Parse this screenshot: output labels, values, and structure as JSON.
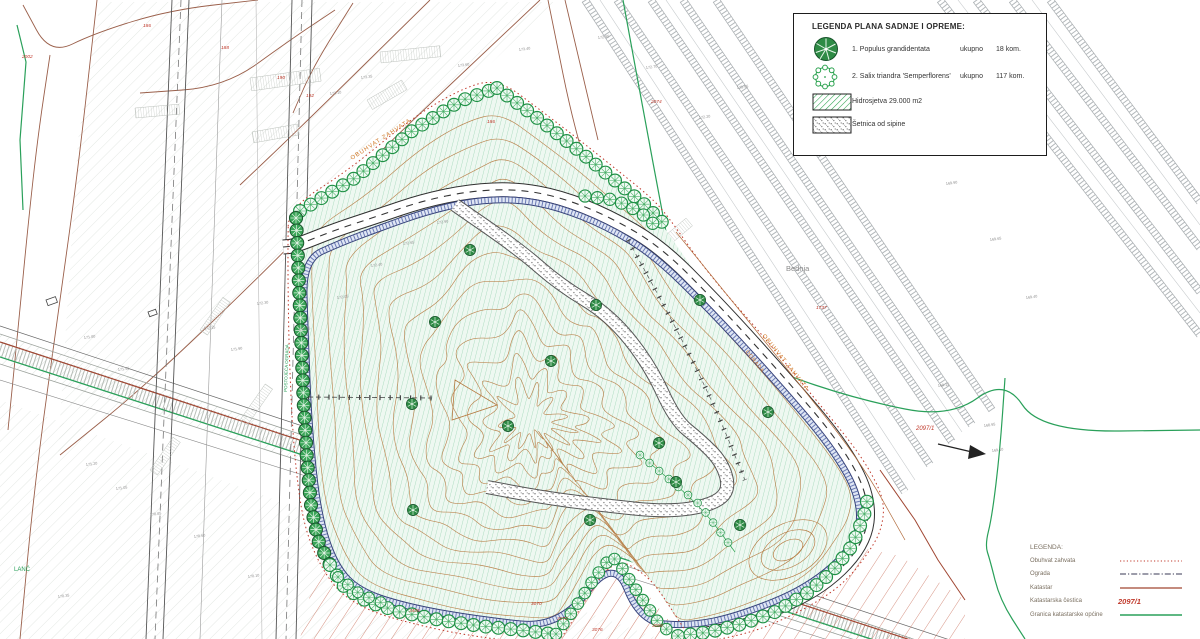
{
  "plant_legend": {
    "title": "LEGENDA PLANA SADNJE I OPREME:",
    "items": [
      {
        "name": "1. Populus grandidentata",
        "qty_label": "ukupno",
        "qty": "18 kom."
      },
      {
        "name": "2. Salix triandra 'Semperflorens'",
        "qty_label": "ukupno",
        "qty": "117 kom."
      },
      {
        "name": "Hidrosjetva 29.000 m2"
      },
      {
        "name": "Šetnica od sipine"
      }
    ]
  },
  "map_legend": {
    "title": "LEGENDA:",
    "items": [
      {
        "label": "Obuhvat zahvata"
      },
      {
        "label": "Ograda"
      },
      {
        "label": "Katastar"
      },
      {
        "label": "Katastarska čestica",
        "value": "2097/1"
      },
      {
        "label": "Granica katastarske općine"
      }
    ]
  },
  "annotations": {
    "river": "Bednja",
    "place": "LANĆ",
    "boundary_label_topleft": "OBUHVAT ZAHVATA",
    "boundary_label_right": "OBUHVAT ZAHVATA",
    "fence_label_right": "OGRADA",
    "fence_label_left": "POSTOJEĆA OGRADA"
  },
  "parcel_numbers": [
    {
      "t": "2002",
      "x": 22,
      "y": 58
    },
    {
      "t": "186",
      "x": 143,
      "y": 27
    },
    {
      "t": "188",
      "x": 221,
      "y": 49
    },
    {
      "t": "190",
      "x": 277,
      "y": 79
    },
    {
      "t": "192",
      "x": 306,
      "y": 97
    },
    {
      "t": "186",
      "x": 487,
      "y": 123
    },
    {
      "t": "2074",
      "x": 651,
      "y": 103
    },
    {
      "t": "1737",
      "x": 816,
      "y": 309
    },
    {
      "t": "2097/1",
      "x": 916,
      "y": 430
    },
    {
      "t": "3405",
      "x": 409,
      "y": 612
    },
    {
      "t": "3070",
      "x": 531,
      "y": 605
    },
    {
      "t": "3072",
      "x": 557,
      "y": 620
    },
    {
      "t": "3076",
      "x": 592,
      "y": 631
    },
    {
      "t": "3068",
      "x": 652,
      "y": 627
    }
  ],
  "elevations": [
    {
      "t": "171.20",
      "x": 86,
      "y": 466
    },
    {
      "t": "171.05",
      "x": 116,
      "y": 490
    },
    {
      "t": "170.85",
      "x": 150,
      "y": 516
    },
    {
      "t": "170.60",
      "x": 194,
      "y": 538
    },
    {
      "t": "172.15",
      "x": 204,
      "y": 330
    },
    {
      "t": "171.90",
      "x": 231,
      "y": 351
    },
    {
      "t": "172.30",
      "x": 257,
      "y": 305
    },
    {
      "t": "171.75",
      "x": 299,
      "y": 331
    },
    {
      "t": "172.05",
      "x": 337,
      "y": 299
    },
    {
      "t": "172.40",
      "x": 371,
      "y": 267
    },
    {
      "t": "172.65",
      "x": 403,
      "y": 245
    },
    {
      "t": "172.90",
      "x": 437,
      "y": 224
    },
    {
      "t": "173.10",
      "x": 330,
      "y": 95
    },
    {
      "t": "173.35",
      "x": 361,
      "y": 79
    },
    {
      "t": "173.60",
      "x": 458,
      "y": 67
    },
    {
      "t": "173.40",
      "x": 519,
      "y": 51
    },
    {
      "t": "172.95",
      "x": 598,
      "y": 39
    },
    {
      "t": "172.70",
      "x": 646,
      "y": 69
    },
    {
      "t": "172.20",
      "x": 699,
      "y": 119
    },
    {
      "t": "171.95",
      "x": 737,
      "y": 89
    },
    {
      "t": "170.40",
      "x": 866,
      "y": 87
    },
    {
      "t": "170.15",
      "x": 900,
      "y": 127
    },
    {
      "t": "169.90",
      "x": 946,
      "y": 185
    },
    {
      "t": "169.65",
      "x": 990,
      "y": 241
    },
    {
      "t": "169.40",
      "x": 1026,
      "y": 299
    },
    {
      "t": "169.15",
      "x": 938,
      "y": 387
    },
    {
      "t": "168.95",
      "x": 984,
      "y": 427
    },
    {
      "t": "171.55",
      "x": 118,
      "y": 371
    },
    {
      "t": "171.80",
      "x": 84,
      "y": 339
    },
    {
      "t": "170.10",
      "x": 248,
      "y": 578
    },
    {
      "t": "170.35",
      "x": 58,
      "y": 598
    },
    {
      "t": "169.10",
      "x": 992,
      "y": 452
    }
  ],
  "colors": {
    "hydroseed_green": "#2aa24e",
    "hatch_green": "#7cc79b",
    "contour_brown": "#b5793f",
    "cadastral_brown": "#9a5f4a",
    "boundary_red": "#c0392b",
    "municipal_green": "#2aa05a",
    "fence_blue": "#36427a",
    "label_orange": "#d07a2a"
  }
}
